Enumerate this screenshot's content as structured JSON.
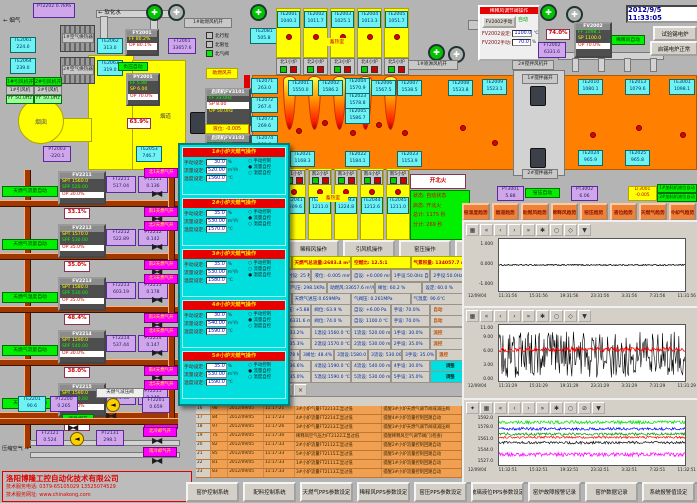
{
  "clock": "2012/9/5 11:33:05",
  "colors": {
    "furnace": "#ff8000",
    "regen": "#ffff00",
    "sensor_box": "#6ef2f2",
    "purple_box": "#cfa6ea",
    "run_green": "#00f000",
    "valve_magenta": "#ff00ff",
    "alarm_row": "#f0a050",
    "trend_button": "#f08238",
    "pipe_brown": "#a03800"
  },
  "top_left": {
    "flue_gas": "烟气",
    "flue_arrow": "←",
    "pt2202_id": "PT2202",
    "pt2202_v": "0.7kPa",
    "soft_water": "软化水",
    "soft_arrow": "←",
    "hx1": "1#空气换热器",
    "hx2": "2#空气换热器",
    "te2061_id": "TE2061",
    "te2061_v": "224.0",
    "te2064_id": "TE2064",
    "te2064_v": "239.0",
    "te2062_id": "TE2062",
    "te2062_v": "313.0",
    "te2063_id": "TE2063",
    "te2063_v": "319.0",
    "fan1_run": "1#引风机开",
    "fan2_run": "2#引风机开",
    "fan1": "1#引风机",
    "fan2": "2#引风机",
    "fan1_ff": "FF 50.0Hz",
    "fan2_ff": "FF 50.0Hz",
    "chimney": "烟囱",
    "flue_duct": "烟道",
    "fy2001": {
      "t": "FY2001",
      "r1": "FF 80.2%",
      "r2": "OP 80.1%"
    },
    "py2001": {
      "t": "PY2001",
      "r1": "FF 5.88",
      "r2": "SP 6.00",
      "r3": "OP 70.0%"
    },
    "neg_auto": "负压自动",
    "damper": "63.9%",
    "ft2001_id": "FT2001",
    "ft2001_v": "33657.6",
    "pt2003_id": "PT2003",
    "pt2003_v": "-220.1",
    "te2053_id": "TE2053",
    "te2053_v": "746.7",
    "te2081_id": "TE2081",
    "te2081_v": "505.8",
    "comb_fan": "1#助燃风机开",
    "comb_open": "助燃风开",
    "spray_fan": "1#喷淋风机开",
    "dilute_fan": "1#稀释风机开",
    "legend": [
      {
        "t": "北行程",
        "c": "#c0c0c0"
      },
      {
        "t": "北限位",
        "c": "#c0c0c0"
      },
      {
        "t": "北气阀",
        "c": "#00f000"
      }
    ]
  },
  "north": {
    "regen_label": "蓄热室",
    "regens": [
      {
        "id": "TE2001",
        "v": "1040.1"
      },
      {
        "id": "TE2002",
        "v": "1011.7"
      },
      {
        "id": "TE2003",
        "v": "1025.1"
      },
      {
        "id": "TE2004",
        "v": "1013.3"
      },
      {
        "id": "TE2005",
        "v": "1051.7"
      }
    ],
    "burners": [
      {
        "t": "北1小炉"
      },
      {
        "t": "北2小炉"
      },
      {
        "t": "北3小炉"
      },
      {
        "t": "北4小炉"
      },
      {
        "t": "北5小炉"
      }
    ],
    "left_col": [
      {
        "id": "TE2071",
        "v": "263.0"
      },
      {
        "id": "TE2072",
        "v": "267.4"
      },
      {
        "id": "TE2073",
        "v": "269.6"
      },
      {
        "id": "TE2074",
        "v": "268.6"
      },
      {
        "id": "TE2075",
        "v": "269.8"
      }
    ],
    "crown": [
      {
        "id": "TE2001",
        "v": "1550.0"
      },
      {
        "id": "TE2002",
        "v": "1586.2"
      },
      {
        "id": "TE2004",
        "v": "1570.9"
      },
      {
        "id": "TE2023",
        "v": "1578.8"
      },
      {
        "id": "TE2005",
        "v": "1586.7"
      },
      {
        "id": "TE2006",
        "v": "1567.5"
      },
      {
        "id": "TE2007",
        "v": "1538.5"
      },
      {
        "id": "TE2008",
        "v": "1533.8"
      }
    ],
    "bottom": [
      {
        "id": "TE2021",
        "v": "1168.3"
      },
      {
        "id": "TE2022",
        "v": "1184.1"
      },
      {
        "id": "TE2023",
        "v": "1153.9"
      }
    ],
    "right": [
      {
        "id": "TE2009",
        "v": "1523.1"
      },
      {
        "id": "TE2010",
        "v": "1080.1"
      },
      {
        "id": "TE2013",
        "v": "1079.6"
      },
      {
        "id": "TE3001",
        "v": "1098.1"
      }
    ],
    "right2": [
      {
        "id": "TE2024",
        "v": "965.9"
      },
      {
        "id": "TE2025",
        "v": "965.8"
      }
    ]
  },
  "south": {
    "label": "蓄热室",
    "items": [
      {
        "b": "南1小炉",
        "id": "TE2041",
        "v": "1209.6"
      },
      {
        "b": "南2小炉",
        "id": "TE2042",
        "v": "1211.0"
      },
      {
        "b": "南3小炉",
        "id": "TE2043",
        "v": "1224.8"
      },
      {
        "b": "南4小炉",
        "id": "TE2044",
        "v": "1212.6"
      },
      {
        "b": "南5小炉",
        "id": "TE2045",
        "v": "1211.0"
      }
    ]
  },
  "top_right": {
    "panel_title": "稀释风调节阀操作",
    "manual_btn": "FV2002手动",
    "auto_lbl": "自动",
    "set_lbl": "FV2002设定:",
    "set_v": "1100.0",
    "set_u": "℃",
    "man_lbl": "FV2002手动:",
    "man_v": "70.0",
    "man_u": "%",
    "damper": "74.0%",
    "ft2002_id": "FT2002",
    "ft2002_v": "6331.6",
    "fv2002": {
      "t": "FV2002",
      "r1": "FF 1098.1",
      "r2": "SP 1100.0",
      "r3": "OP 70.0%"
    },
    "auto2": "稀释风自动",
    "btn_test": "试验锡电炉",
    "btn_ok": "启锡电炉正常",
    "stir_fan": "2#搅拌风机开",
    "stir1": "1#搅拌器开",
    "stir2": "2#搅拌器开"
  },
  "feeders": {
    "f1": {
      "t": "启闭机FV3101",
      "r1": "FF 33.0Hz",
      "r2": "SP 8.00",
      "r3": "OP 50.0Hz"
    },
    "f2": {
      "t": "启闭机FV3102",
      "r1": "FF 33.0Hz",
      "r2": "SP 8.00",
      "r3": "OP 50.0Hz"
    },
    "lvl": "液位: -0.005"
  },
  "gas_trains": [
    {
      "fv": "FV2211",
      "mode": "天燃气流量自动",
      "spt": "SPT 1560.0",
      "spf": "SPF 520.00",
      "op": "OP 30.0%",
      "pos": "33.1%",
      "ftid": "FT2211",
      "ftv": "517.04",
      "ptid": "PT2211",
      "ptv": "0.136",
      "vn": "北1天燃气开",
      "vs": "南1天燃气开"
    },
    {
      "fv": "FV2212",
      "mode": "天燃气流量自动",
      "spt": "SPT 1570.0",
      "spf": "SPF 530.00",
      "op": "OP 35.0%",
      "pos": "35.0%",
      "ftid": "FT2212",
      "ftv": "522.89",
      "ptid": "PT2212",
      "ptv": "0.142",
      "vn": "北2天燃气开",
      "vs": "南2天燃气开"
    },
    {
      "fv": "FV2213",
      "mode": "天燃气温度自动",
      "spt": "SPT 1580.0",
      "spf": "SPF 530.00",
      "op": "OP 35.0%",
      "pos": "48.4%",
      "ftid": "FT2213",
      "ftv": "603.19",
      "ptid": "PT2213",
      "ptv": "0.178",
      "vn": "北3天燃气开",
      "vs": "南3天燃气开"
    },
    {
      "fv": "FV2214",
      "mode": "天燃气流量自动",
      "spt": "SPT 1590.0",
      "spf": "SPF 540.00",
      "op": "OP 30.0%",
      "pos": "38.0%",
      "ftid": "FT2214",
      "ftv": "537.44",
      "ptid": "PT2214",
      "ptv": "0.147",
      "vn": "北4天燃气开",
      "vs": "南4天燃气开"
    },
    {
      "fv": "FV2215",
      "mode": "天燃气流量自动",
      "spt": "SPT 1590.0",
      "spf": "SPF 530.00",
      "op": "OP 35.0%",
      "pos": "35.0%",
      "ftid": "FT2215",
      "ftv": "524.58",
      "ptid": "PT2215",
      "ptv": "0.140",
      "vn": "北5天燃气开",
      "vs": "南5天燃气开"
    }
  ],
  "gas_misc": {
    "te2201_id": "TE2201",
    "te2201_v": "90.6",
    "pt2200_id": "PT2200",
    "pt2200_v": "0.265",
    "emerg": "紧急阀开",
    "prv": "天燃气减压阀",
    "ft2201_id": "FT2201",
    "ft2201_v": "0.659",
    "air_lbl": "压缩空气",
    "air_arrow": "→",
    "ft2121_id": "FT2121",
    "ft2121_v": "0.524",
    "pt2131_id": "PT2131",
    "pt2131_v": "298.1",
    "vn": "北冷却气开",
    "vs": "南冷却气开"
  },
  "company": {
    "name": "洛阳博隆工控自动化技术有限公司",
    "phone": "技术服务电话: 0379-65105029  13525074529",
    "web": "技术服务网址: www.chinakong.com"
  },
  "popup": {
    "panels": [
      {
        "title": "1#小炉天燃气操作",
        "f1l": "手动设定:",
        "f1v": "30.0",
        "f1u": "%",
        "f2l": "流量设定:",
        "f2v": "520.00",
        "f2u": "m³/h",
        "f3l": "温度设定:",
        "f3v": "1560.0",
        "f3u": "℃",
        "r1d": "○",
        "r1t": "手动控制",
        "r2d": "●",
        "r2t": "流量自控",
        "r3d": "○",
        "r3t": "温度自控"
      },
      {
        "title": "2#小炉天燃气操作",
        "f1l": "手动设定:",
        "f1v": "35.0",
        "f1u": "%",
        "f2l": "流量设定:",
        "f2v": "530.00",
        "f2u": "m³/h",
        "f3l": "温度设定:",
        "f3v": "1570.0",
        "f3u": "℃",
        "r1d": "○",
        "r1t": "手动控制",
        "r2d": "●",
        "r2t": "流量自控",
        "r3d": "○",
        "r3t": "温度自控"
      },
      {
        "title": "3#小炉天燃气操作",
        "f1l": "手动设定:",
        "f1v": "35.0",
        "f1u": "%",
        "f2l": "流量设定:",
        "f2v": "530.00",
        "f2u": "m³/h",
        "f3l": "温度设定:",
        "f3v": "1580.0",
        "f3u": "℃",
        "r1d": "○",
        "r1t": "手动控制",
        "r2d": "○",
        "r2t": "流量自控",
        "r3d": "●",
        "r3t": "温度自控"
      },
      {
        "title": "4#小炉天燃气操作",
        "f1l": "手动设定:",
        "f1v": "30.0",
        "f1u": "%",
        "f2l": "流量设定:",
        "f2v": "540.00",
        "f2u": "m³/h",
        "f3l": "温度设定:",
        "f3v": "1590.0",
        "f3u": "℃",
        "r1d": "○",
        "r1t": "手动控制",
        "r2d": "●",
        "r2t": "流量自控",
        "r3d": "○",
        "r3t": "温度自控"
      },
      {
        "title": "5#小炉天燃气操作",
        "f1l": "手动设定:",
        "f1v": "35.0",
        "f1u": "%",
        "f2l": "流量设定:",
        "f2v": "530.00",
        "f2u": "m³/h",
        "f3l": "温度设定:",
        "f3v": "1590.0",
        "f3u": "℃",
        "r1d": "○",
        "r1t": "手动控制",
        "r2d": "●",
        "r2t": "流量自控",
        "r3d": "○",
        "r3t": "温度自控"
      }
    ]
  },
  "status": {
    "fire_btn": "开北火",
    "l1": "状态: 自动状态",
    "l2": "启态: 开北火",
    "l3": "总计: 1175 秒",
    "l4": "分计: 269 秒"
  },
  "ops_buttons": [
    {
      "t": "助燃风操作"
    },
    {
      "t": "稀释风操作"
    },
    {
      "t": "引风机操作"
    },
    {
      "t": "窑压操作"
    },
    {
      "t": "玻璃液位操作"
    },
    {
      "t": "天燃气操作"
    }
  ],
  "kiln_row": {
    "pt3001_id": "PT3001",
    "pt3001_v": "5.88",
    "auto": "窑压自动",
    "pt3002_id": "PT3002",
    "pt3002_v": "6.06",
    "lt3001_id": "LT3001",
    "lt3001_v": "-0.005",
    "f1": "1#加料机液位自动",
    "f2": "2#加料机液位自动"
  },
  "trend_buttons": [
    {
      "t": "窑温度趋势"
    },
    {
      "t": "烟道趋势"
    },
    {
      "t": "助燃风趋势"
    },
    {
      "t": "稀释风趋势"
    },
    {
      "t": "窑压趋势"
    },
    {
      "t": "液位趋势"
    },
    {
      "t": "天燃气趋势"
    },
    {
      "t": "冷却气趋势"
    }
  ],
  "summary": {
    "strip": [
      {
        "t": "助燃风量:33657.6 m³/h"
      },
      {
        "t": "天燃气总流量:2683.4 m³/h"
      },
      {
        "t": "空燃比: 12.5:1"
      },
      {
        "t": "气累积量: 134057.7 m³"
      }
    ],
    "r0": [
      {
        "t": "北换火时设: 25 秒"
      },
      {
        "t": "南换火时设: 25 秒"
      },
      {
        "t": "液位: -0.005 mm"
      },
      {
        "t": "自设: +0.000 mm"
      },
      {
        "t": "1手设:50.0Hz 自动"
      },
      {
        "t": "2手设:50.0Hz 自动"
      }
    ],
    "r1": [
      {
        "t": "氮气压力:0.794 MPa"
      },
      {
        "t": "冷却气压: 298.1KPa"
      },
      {
        "t": "助燃风:33657.6 m³/h"
      },
      {
        "t": "阀位: 60.2 %"
      },
      {
        "t": "设定: 60.0 %"
      }
    ],
    "r2": [
      {
        "t": "压缩气压:0.524 MPa"
      },
      {
        "t": "天燃气进压:0.659MPa"
      },
      {
        "t": "气阀压: 0.261MPa"
      },
      {
        "t": "气温度: 90.6℃"
      }
    ],
    "r3": [
      {
        "t": "窑压: +6.06 Pa"
      },
      {
        "t": "烟道窑压: +5.88 Pa"
      },
      {
        "t": "阀位: 63.9 %"
      },
      {
        "t": "自设: +6.00 Pa"
      },
      {
        "t": "手设: 70.0%"
      },
      {
        "t": "自动"
      }
    ],
    "r4": [
      {
        "t": "稀温: 1098.1℃"
      },
      {
        "t": "稀释风:6331.6 m³/h"
      },
      {
        "t": "阀位: 74.0 %"
      },
      {
        "t": "自设: 1100.0 ℃"
      },
      {
        "t": "手设: 70.0%"
      },
      {
        "t": "自动"
      }
    ],
    "b0": [
      {
        "t": "1压力:0.136 MPa"
      },
      {
        "t": "1阀位: 33.2%"
      },
      {
        "t": "1温设:1560.0 ℃"
      },
      {
        "t": "1流设: 520.00 m³/h"
      },
      {
        "t": "1手设: 30.0%"
      },
      {
        "t": "流控"
      }
    ],
    "b1": [
      {
        "t": "2压力:0.142 MPa"
      },
      {
        "t": "2阀位: 35.3%"
      },
      {
        "t": "2温设:1570.0 ℃"
      },
      {
        "t": "2流设: 530.00 m³/h"
      },
      {
        "t": "2手设: 35.0%"
      },
      {
        "t": "流控"
      }
    ],
    "b2": [
      {
        "t": "3顶温:1586.7℃"
      },
      {
        "t": "3压力:0.178 MPa"
      },
      {
        "t": "3阀位: 48.4%"
      },
      {
        "t": "3温设:1580.0 ℃"
      },
      {
        "t": "3流设: 530.00 m³/h"
      },
      {
        "t": "3手设: 35.0%"
      },
      {
        "t": "温控"
      }
    ],
    "b3": [
      {
        "t": "4压力:0.147 MPa"
      },
      {
        "t": "4阀位: 36.6%"
      },
      {
        "t": "4温设:1590.0 ℃"
      },
      {
        "t": "4流设: 540.00 m³/h"
      },
      {
        "t": "4手设: 30.0%"
      },
      {
        "t": "调整"
      }
    ],
    "b4": [
      {
        "t": "5压力:0.140 MPa"
      },
      {
        "t": "5阀位: 35.0%"
      },
      {
        "t": "5温设:1590.0 ℃"
      },
      {
        "t": "5流设: 530.00 m³/h"
      },
      {
        "t": "5手设: 35.0%"
      },
      {
        "t": "调整"
      }
    ]
  },
  "alarm": {
    "toolbar": [
      {
        "g": "▣"
      },
      {
        "g": "≡"
      },
      {
        "g": "?"
      },
      {
        "g": "▦"
      },
      {
        "g": "▤"
      },
      {
        "g": "⊞"
      },
      {
        "g": "▲"
      },
      {
        "g": "×"
      }
    ],
    "headers": [
      {
        "t": ""
      },
      {
        "t": ""
      },
      {
        "t": ""
      },
      {
        "t": ""
      },
      {
        "t": "故障点"
      },
      {
        "t": "故障原因 (供参考)"
      }
    ],
    "rows": [
      [
        "16",
        "98",
        "2012/09/05",
        "11:17:21",
        "3#小炉气量FT2213工显过低",
        "提醒3#小炉天燃气调节阀或减压阀"
      ],
      [
        "17",
        "84",
        "2012/09/05",
        "11:17:23",
        "4#小炉流量FT2214工显过低",
        "提醒4#小炉流量控制回路自动"
      ],
      [
        "18",
        "97",
        "2012/09/05",
        "11:17:26",
        "3#小炉气量FT2213工显过低",
        "提醒3#小炉天燃气调节阀或减压阀"
      ],
      [
        "19",
        "75",
        "2012/09/05",
        "11:17:30",
        "稀释风空气压力FT2122工显过低",
        "提醒稀释风空气调节阀门(检查)"
      ],
      [
        "20",
        "82",
        "2012/09/05",
        "11:17:33",
        "2#小炉流量FT2112工显过低",
        "提醒2#小炉流量控制回路自动"
      ],
      [
        "21",
        "85",
        "2012/09/05",
        "11:17:33",
        "5#小炉流量FT2115工显过低",
        "提醒5#小炉流量控制回路自动"
      ],
      [
        "22",
        "81",
        "2012/09/05",
        "11:17:33",
        "1#小炉流量FT2111工显过低",
        "提醒1#小炉流量控制回路自动"
      ],
      [
        "23",
        "83",
        "2012/09/05",
        "11:17:33",
        "3#小炉流量FT2113工显过低",
        "提醒3#小炉流量控制回路自动"
      ]
    ]
  },
  "bottom_buttons": [
    {
      "t": "窑炉控制系统"
    },
    {
      "t": "配料控制系统"
    },
    {
      "t": "天燃气PPS参数设定"
    },
    {
      "t": "稀释风PPS参数设定"
    },
    {
      "t": "窑压PPS参数设定"
    },
    {
      "t": "玻璃液位PPS参数设定"
    },
    {
      "t": "窑炉故障报警记录"
    },
    {
      "t": "窑炉数据记录"
    },
    {
      "t": "系统报警值设定"
    }
  ],
  "ctb": [
    {
      "g": "▦"
    },
    {
      "g": "«"
    },
    {
      "g": "‹"
    },
    {
      "g": "›"
    },
    {
      "g": "»"
    },
    {
      "g": "✱"
    },
    {
      "g": "○"
    },
    {
      "g": "◇"
    },
    {
      "g": "▼"
    }
  ],
  "ctb3": [
    {
      "g": "✦"
    },
    {
      "g": "▦"
    },
    {
      "g": "«"
    },
    {
      "g": "‹"
    },
    {
      "g": "›"
    },
    {
      "g": "»"
    },
    {
      "g": "✱"
    },
    {
      "g": "○"
    },
    {
      "g": "⊘"
    },
    {
      "g": "▼"
    }
  ],
  "chart_data": [
    {
      "type": "line",
      "title": "玻璃液位趋势",
      "xdate": "12/09/04",
      "ylim": [
        -1.3,
        1.3
      ],
      "yticks": [
        {
          "label": "1.000",
          "v": 1
        },
        {
          "label": "0.000",
          "v": 0
        },
        {
          "label": "-1.000",
          "v": -1
        }
      ],
      "xticks": [
        "11:31:56",
        "15:31:56",
        "19:31:56",
        "23:31:56",
        "3:31:56",
        "7:31:56",
        "11:31:56"
      ],
      "grid": false,
      "legend": "none",
      "series": [
        {
          "color": "#000000",
          "base": 0,
          "amp": 0.03,
          "w": 0.8
        }
      ]
    },
    {
      "type": "line",
      "title": "窑压趋势",
      "xdate": "12/09/04",
      "ylim": [
        -0.2,
        11.9
      ],
      "yticks": [
        {
          "label": "11.00",
          "v": 11
        },
        {
          "label": "9.00",
          "v": 9
        },
        {
          "label": "6.00",
          "v": 6
        },
        {
          "label": "3.00",
          "v": 3
        },
        {
          "label": "0.00",
          "v": 0
        }
      ],
      "xticks": [
        "11:31:29",
        "15:31:29",
        "19:31:29",
        "23:31:29",
        "3:31:29",
        "7:31:29",
        "11:31:29"
      ],
      "grid": false,
      "legend": "none",
      "series": [
        {
          "color": "#000000",
          "base": 5.5,
          "amp": 5,
          "w": 0.6
        },
        {
          "color": "#ff0000",
          "base": 6.6,
          "amp": 0.5,
          "w": 0.8
        }
      ]
    },
    {
      "type": "line",
      "title": "窑温度趋势",
      "xdate": "12/09/04",
      "ylim": [
        1523,
        1596
      ],
      "yticks": [
        {
          "label": "1592.0",
          "v": 1592
        },
        {
          "label": "1578.0",
          "v": 1578
        },
        {
          "label": "1561.0",
          "v": 1561
        },
        {
          "label": "1544.0",
          "v": 1544
        },
        {
          "label": "1527.0",
          "v": 1527
        }
      ],
      "xticks": [
        "11:32:51",
        "15:32:51",
        "19:32:51",
        "23:32:51",
        "3:32:51",
        "7:32:51",
        "11:32:51"
      ],
      "grid": false,
      "legend": "none",
      "series": [
        {
          "color": "#00dd00",
          "base": 1588,
          "amp": 2.5,
          "w": 0.7
        },
        {
          "color": "#0000ff",
          "base": 1578,
          "amp": 2,
          "w": 0.7
        },
        {
          "color": "#009900",
          "base": 1570,
          "amp": 2,
          "w": 0.7
        },
        {
          "color": "#ff0000",
          "base": 1565,
          "amp": 1.5,
          "w": 0.7
        },
        {
          "color": "#111111",
          "base": 1557,
          "amp": 2,
          "w": 0.7
        },
        {
          "color": "#ff00ff",
          "base": 1539,
          "amp": 3,
          "w": 0.7
        }
      ]
    }
  ]
}
